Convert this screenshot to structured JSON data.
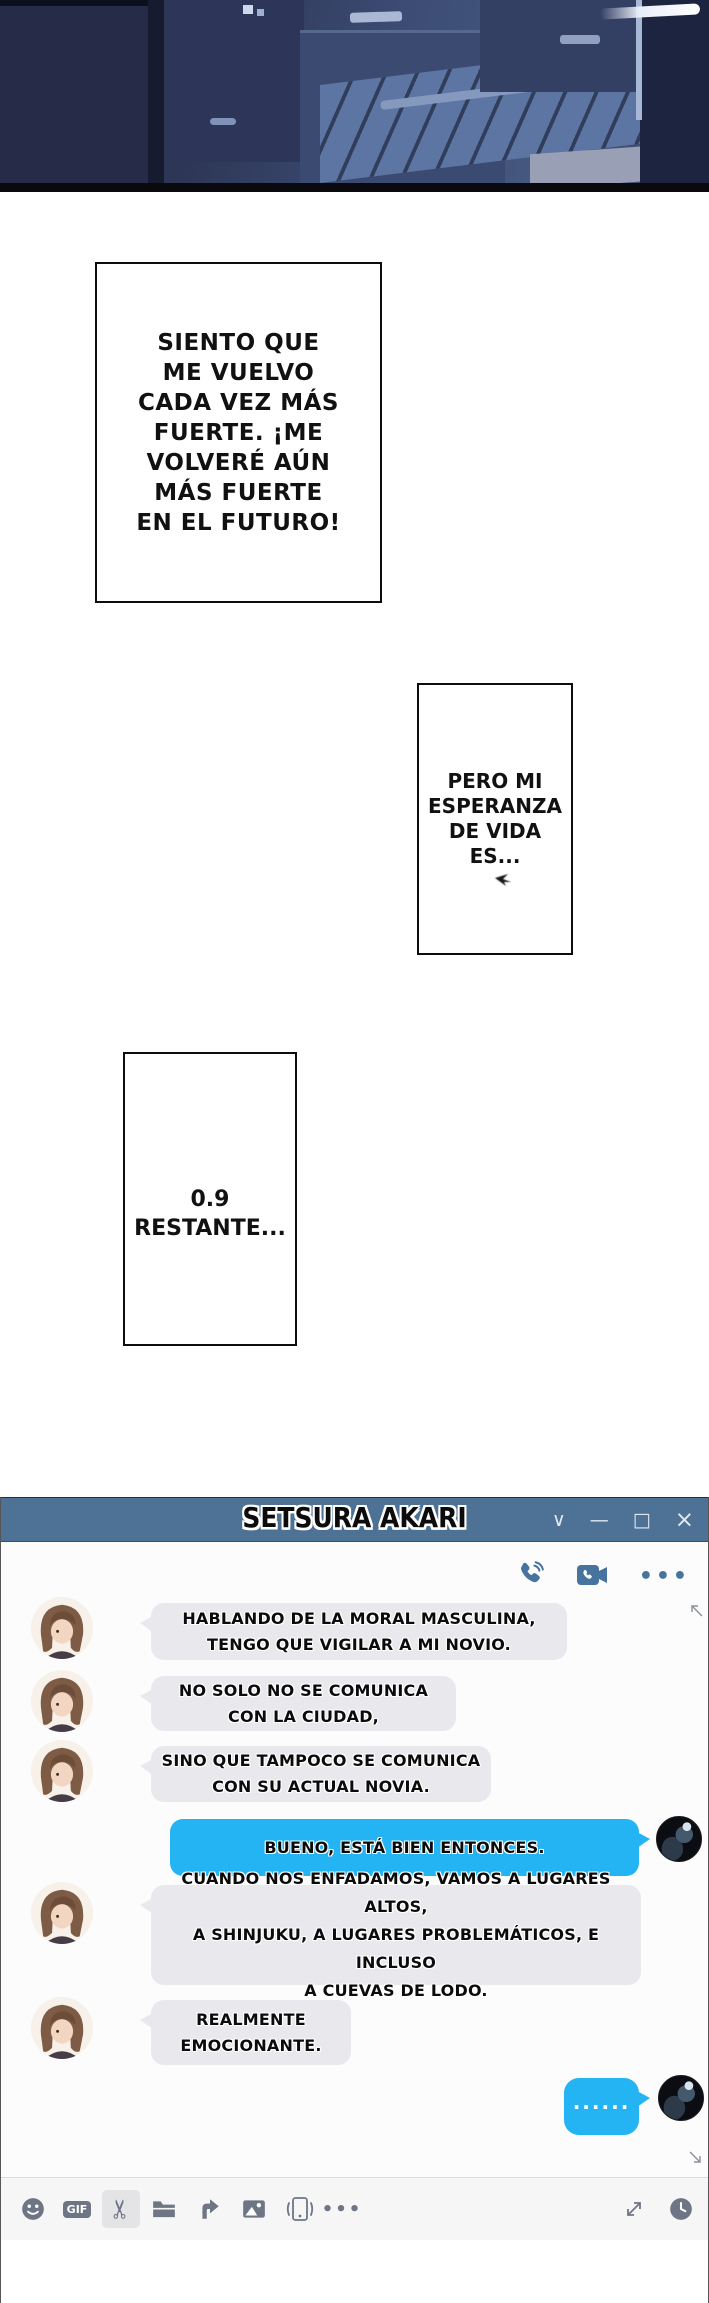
{
  "manga": {
    "panels": [
      {
        "text": "SIENTO QUE\nME VUELVO\nCADA VEZ MÁS\nFUERTE. ¡ME\nVOLVERÉ AÚN\nMÁS FUERTE\nEN EL FUTURO!"
      },
      {
        "text": "PERO MI\nESPERANZA\nDE VIDA\nES..."
      },
      {
        "text": "0.9\nRESTANTE..."
      }
    ]
  },
  "chat": {
    "title": "SETSURA AKARI",
    "window_controls": {
      "chevron": "∨",
      "minimize": "—",
      "maximize": "□",
      "close": "×"
    },
    "header": {
      "more_label": "•••"
    },
    "colors": {
      "titlebar": "#4d7296",
      "sent_bubble": "#25b4f3",
      "received_bubble": "#e9e8ec",
      "header_icon": "#47749f",
      "toolbar_icon": "#6e7585"
    },
    "messages": [
      {
        "from": "contact",
        "text": "HABLANDO DE LA MORAL MASCULINA,\nTENGO QUE VIGILAR A MI NOVIO."
      },
      {
        "from": "contact",
        "text": "NO SOLO NO SE COMUNICA\nCON LA CIUDAD,"
      },
      {
        "from": "contact",
        "text": "SINO QUE TAMPOCO SE COMUNICA\nCON SU ACTUAL NOVIA."
      },
      {
        "from": "user",
        "text": "BUENO, ESTÁ BIEN ENTONCES."
      },
      {
        "from": "contact",
        "text": "CUANDO NOS ENFADAMOS, VAMOS A LUGARES ALTOS,\nA SHINJUKU, A LUGARES PROBLEMÁTICOS, E INCLUSO\nA CUEVAS DE LODO."
      },
      {
        "from": "contact",
        "text": "REALMENTE\nEMOCIONANTE."
      },
      {
        "from": "user",
        "text": "······"
      }
    ],
    "toolbar": {
      "gif_label": "GIF",
      "more_label": "•••"
    }
  }
}
